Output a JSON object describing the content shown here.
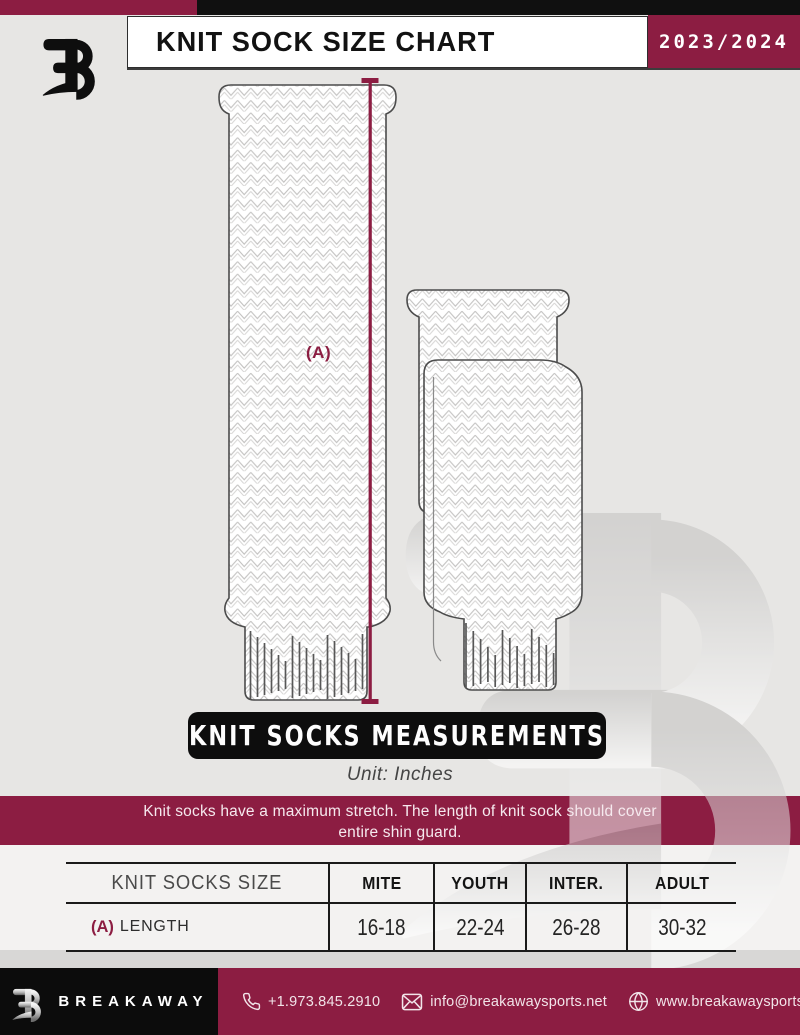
{
  "header": {
    "title": "KNIT SOCK SIZE CHART",
    "season": "2023/2024"
  },
  "diagram": {
    "measurement_label": "(A)",
    "banner": "KNIT SOCKS MEASUREMENTS",
    "unit": "Unit: Inches"
  },
  "notice": {
    "line1": "Knit socks have a maximum stretch. The length of knit sock should cover",
    "line2": "entire shin guard."
  },
  "table": {
    "headers": [
      "KNIT SOCKS SIZE",
      "MITE",
      "YOUTH",
      "INTER.",
      "ADULT"
    ],
    "row": {
      "prefix": "(A)",
      "label": "LENGTH",
      "values": [
        "16-18",
        "22-24",
        "26-28",
        "30-32"
      ]
    }
  },
  "chart_data": {
    "type": "table",
    "title": "KNIT SOCK SIZE CHART",
    "unit": "Inches",
    "columns": [
      "KNIT SOCKS SIZE",
      "MITE",
      "YOUTH",
      "INTER.",
      "ADULT"
    ],
    "rows": [
      [
        "(A) LENGTH",
        "16-18",
        "22-24",
        "26-28",
        "30-32"
      ]
    ]
  },
  "footer": {
    "brand": "BREAKAWAY",
    "phone": "+1.973.845.2910",
    "email": "info@breakawaysports.net",
    "website": "www.breakawaysports.net"
  },
  "colors": {
    "maroon": "#8C1D42",
    "black": "#0d0d0d",
    "background_gray": "#e7e6e4"
  }
}
